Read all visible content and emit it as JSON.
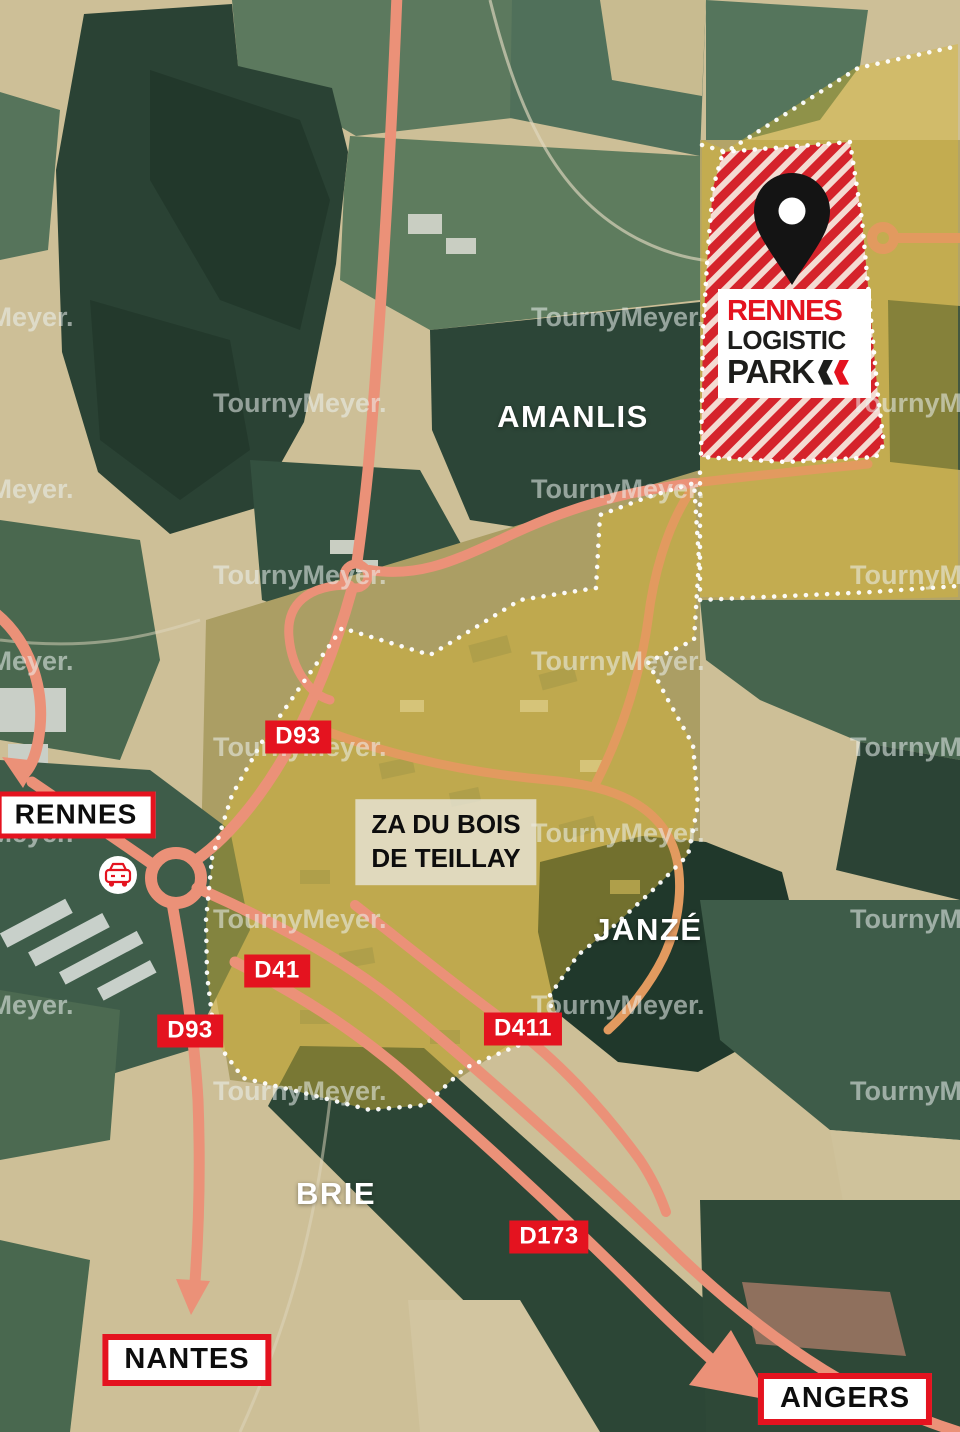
{
  "watermark": {
    "text": "TournyMeyer."
  },
  "logo": {
    "pin_icon": "location-pin",
    "line1": "RENNES",
    "line2": "LOGISTIC",
    "line3": "PARK",
    "chevron_icon": "double-left-chevron"
  },
  "places": {
    "amanlis": "AMANLIS",
    "janze": "JANZÉ",
    "brie": "BRIE"
  },
  "zone_label": {
    "line1": "ZA DU BOIS",
    "line2": "DE TEILLAY"
  },
  "roads": {
    "d93_north": "D93",
    "d41": "D41",
    "d93_south": "D93",
    "d411": "D411",
    "d173": "D173"
  },
  "destinations": {
    "rennes": "RENNES",
    "nantes": "NANTES",
    "angers": "ANGERS"
  },
  "icons": {
    "car": "car-icon",
    "pin": "location-pin-icon",
    "roundabout": "roundabout-ring",
    "junction_node": "junction-node-ring"
  },
  "colors": {
    "accent_red": "#E4131F",
    "road_salmon": "#EB9178",
    "road_orange": "#E29A5F",
    "zone_yellow_overlay": "rgba(216,182,52,0.45)",
    "hatch_red": "#D5232B",
    "pin_black": "#141414",
    "watermark_white": "rgba(236,243,241,0.55)"
  }
}
